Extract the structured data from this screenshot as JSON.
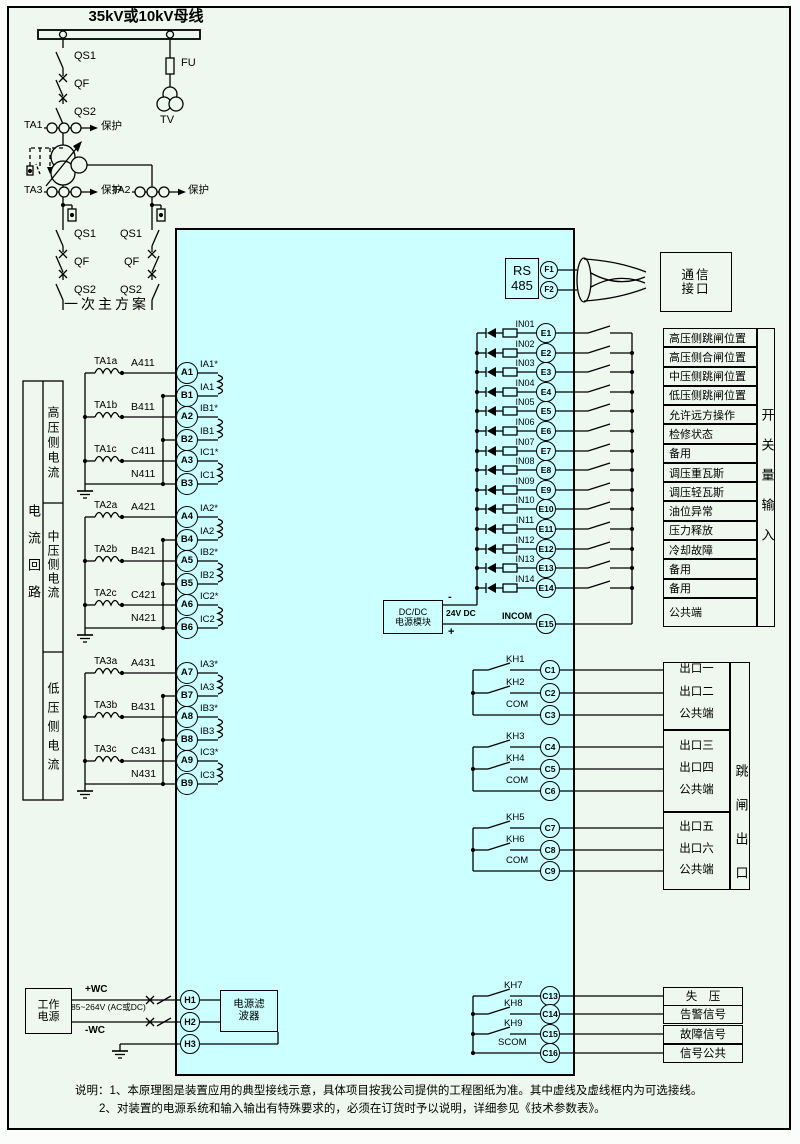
{
  "colors": {
    "page_bg": "#eef8ee",
    "device_fill": "#ccffff",
    "stroke": "#000000"
  },
  "one_line": {
    "title": "35kV或10kV母线",
    "caption": "一次主方案",
    "qs1": "QS1",
    "qf": "QF",
    "qs2": "QS2",
    "fu": "FU",
    "tv": "TV",
    "ta1": "TA1",
    "ta2": "TA2",
    "ta3": "TA3",
    "protect": "保护"
  },
  "current_section": {
    "side_label": "电流回路",
    "groups": [
      {
        "cell_label": "高压侧电流",
        "rows": [
          {
            "ct": "TA1a",
            "wire": "A411",
            "term_a": "A1",
            "coil_top": "IA1*",
            "term_b": "B1",
            "coil_bot": "IA1"
          },
          {
            "ct": "TA1b",
            "wire": "B411",
            "term_a": "A2",
            "coil_top": "IB1*",
            "term_b": "B2",
            "coil_bot": "IB1"
          },
          {
            "ct": "TA1c",
            "wire": "C411",
            "term_a": "A3",
            "coil_top": "IC1*",
            "term_b": "B3",
            "coil_bot": "IC1",
            "neutral": "N411"
          }
        ]
      },
      {
        "cell_label": "中压侧电流",
        "rows": [
          {
            "ct": "TA2a",
            "wire": "A421",
            "term_a": "A4",
            "coil_top": "IA2*",
            "term_b": "B4",
            "coil_bot": "IA2"
          },
          {
            "ct": "TA2b",
            "wire": "B421",
            "term_a": "A5",
            "coil_top": "IB2*",
            "term_b": "B5",
            "coil_bot": "IB2"
          },
          {
            "ct": "TA2c",
            "wire": "C421",
            "term_a": "A6",
            "coil_top": "IC2*",
            "term_b": "B6",
            "coil_bot": "IC2",
            "neutral": "N421"
          }
        ]
      },
      {
        "cell_label": "低压侧电流",
        "rows": [
          {
            "ct": "TA3a",
            "wire": "A431",
            "term_a": "A7",
            "coil_top": "IA3*",
            "term_b": "B7",
            "coil_bot": "IA3"
          },
          {
            "ct": "TA3b",
            "wire": "B431",
            "term_a": "A8",
            "coil_top": "IB3*",
            "term_b": "B8",
            "coil_bot": "IB3"
          },
          {
            "ct": "TA3c",
            "wire": "C431",
            "term_a": "A9",
            "coil_top": "IC3*",
            "term_b": "B9",
            "coil_bot": "IC3",
            "neutral": "N431"
          }
        ]
      }
    ]
  },
  "comm": {
    "rs_line1": "RS",
    "rs_line2": "485",
    "f1": "F1",
    "f2": "F2",
    "box_line1": "通信",
    "box_line2": "接口"
  },
  "digital_inputs": {
    "side_label": "开关量输入",
    "rows": [
      {
        "wire": "IN01",
        "term": "E1",
        "label": "高压侧跳闸位置"
      },
      {
        "wire": "IN02",
        "term": "E2",
        "label": "高压侧合闸位置"
      },
      {
        "wire": "IN03",
        "term": "E3",
        "label": "中压侧跳闸位置"
      },
      {
        "wire": "IN04",
        "term": "E4",
        "label": "低压侧跳闸位置"
      },
      {
        "wire": "IN05",
        "term": "E5",
        "label": "允许远方操作"
      },
      {
        "wire": "IN06",
        "term": "E6",
        "label": "检修状态"
      },
      {
        "wire": "IN07",
        "term": "E7",
        "label": "备用"
      },
      {
        "wire": "IN08",
        "term": "E8",
        "label": "调压重瓦斯"
      },
      {
        "wire": "IN09",
        "term": "E9",
        "label": "调压轻瓦斯"
      },
      {
        "wire": "IN10",
        "term": "E10",
        "label": "油位异常"
      },
      {
        "wire": "IN11",
        "term": "E11",
        "label": "压力释放"
      },
      {
        "wire": "IN12",
        "term": "E12",
        "label": "冷却故障"
      },
      {
        "wire": "IN13",
        "term": "E13",
        "label": "备用"
      },
      {
        "wire": "IN14",
        "term": "E14",
        "label": "备用"
      }
    ],
    "incom": {
      "wire": "INCOM",
      "term": "E15",
      "label": "公共端"
    },
    "dcdc": {
      "line1": "DC/DC",
      "line2": "电源模块",
      "volt": "24V DC",
      "minus": "-",
      "plus": "+"
    }
  },
  "outputs": {
    "side_label": "跳闸出口",
    "groups": [
      [
        {
          "contact": "KH1",
          "term": "C1",
          "label": "出口一"
        },
        {
          "contact": "KH2",
          "term": "C2",
          "label": "出口二"
        },
        {
          "contact": "COM",
          "term": "C3",
          "label": "公共端"
        }
      ],
      [
        {
          "contact": "KH3",
          "term": "C4",
          "label": "出口三"
        },
        {
          "contact": "KH4",
          "term": "C5",
          "label": "出口四"
        },
        {
          "contact": "COM",
          "term": "C6",
          "label": "公共端"
        }
      ],
      [
        {
          "contact": "KH5",
          "term": "C7",
          "label": "出口五"
        },
        {
          "contact": "KH6",
          "term": "C8",
          "label": "出口六"
        },
        {
          "contact": "COM",
          "term": "C9",
          "label": "公共端"
        }
      ]
    ]
  },
  "signals": {
    "rows": [
      {
        "contact": "KH7",
        "term": "C13",
        "label": "失　压"
      },
      {
        "contact": "KH8",
        "term": "C14",
        "label": "告警信号"
      },
      {
        "contact": "KH9",
        "term": "C15",
        "label": "故障信号"
      },
      {
        "contact": "SCOM",
        "term": "C16",
        "label": "信号公共"
      }
    ]
  },
  "power": {
    "box_line1": "工作",
    "box_line2": "电源",
    "plus": "+WC",
    "range": "85~264V (AC或DC)",
    "minus": "-WC",
    "terms": [
      "H1",
      "H2",
      "H3"
    ],
    "filter_line1": "电源滤",
    "filter_line2": "波器"
  },
  "notes": {
    "line1": "说明：1、本原理图是装置应用的典型接线示意，具体项目按我公司提供的工程图纸为准。其中虚线及虚线框内为可选接线。",
    "line2": "2、对装置的电源系统和输入输出有特殊要求的，必须在订货时予以说明，详细参见《技术参数表》。"
  }
}
